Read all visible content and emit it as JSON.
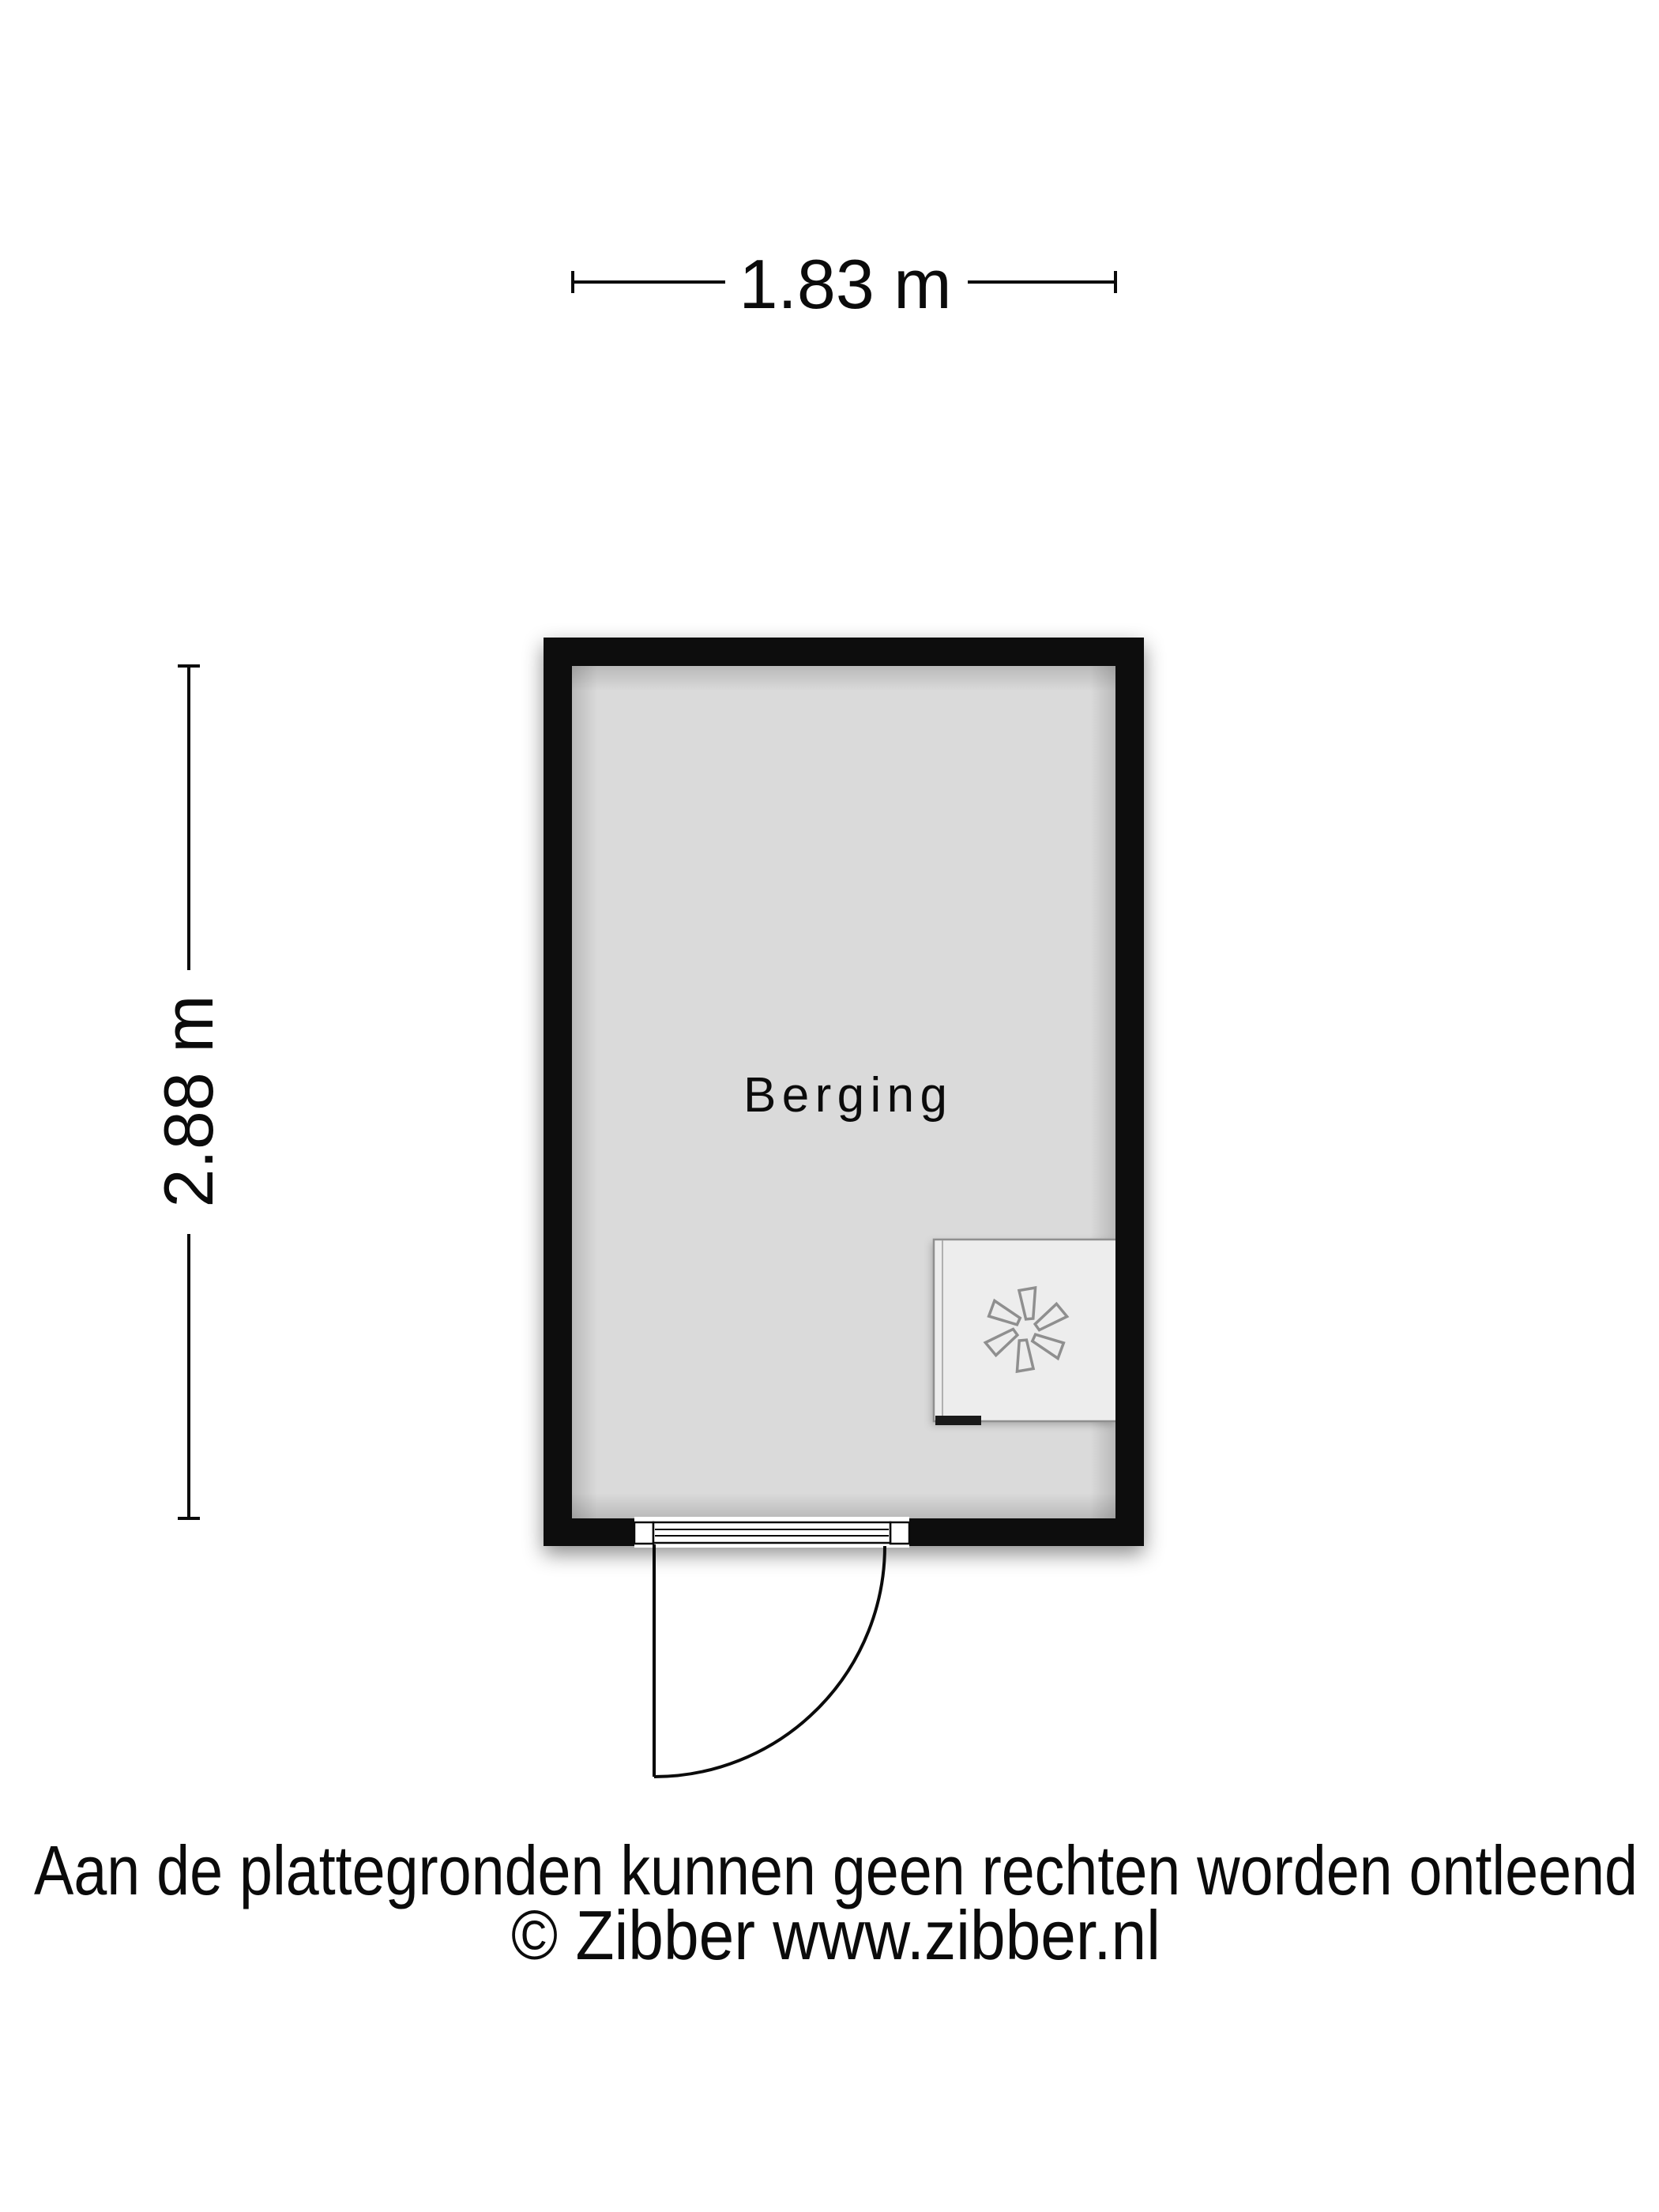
{
  "floorplan": {
    "room_label": "Berging",
    "dimensions": {
      "width_label": "1.83 m",
      "height_label": "2.88 m"
    },
    "colors": {
      "wall": "#0c0c0c",
      "floor": "#dadada",
      "fixture_fill": "#ededed",
      "fixture_stroke": "#8f8f8f",
      "line": "#000000"
    },
    "icons": {
      "fixture": "fan-icon"
    }
  },
  "footer": {
    "disclaimer": "Aan de plattegronden kunnen geen rechten worden ontleend",
    "copyright": "© Zibber www.zibber.nl"
  }
}
